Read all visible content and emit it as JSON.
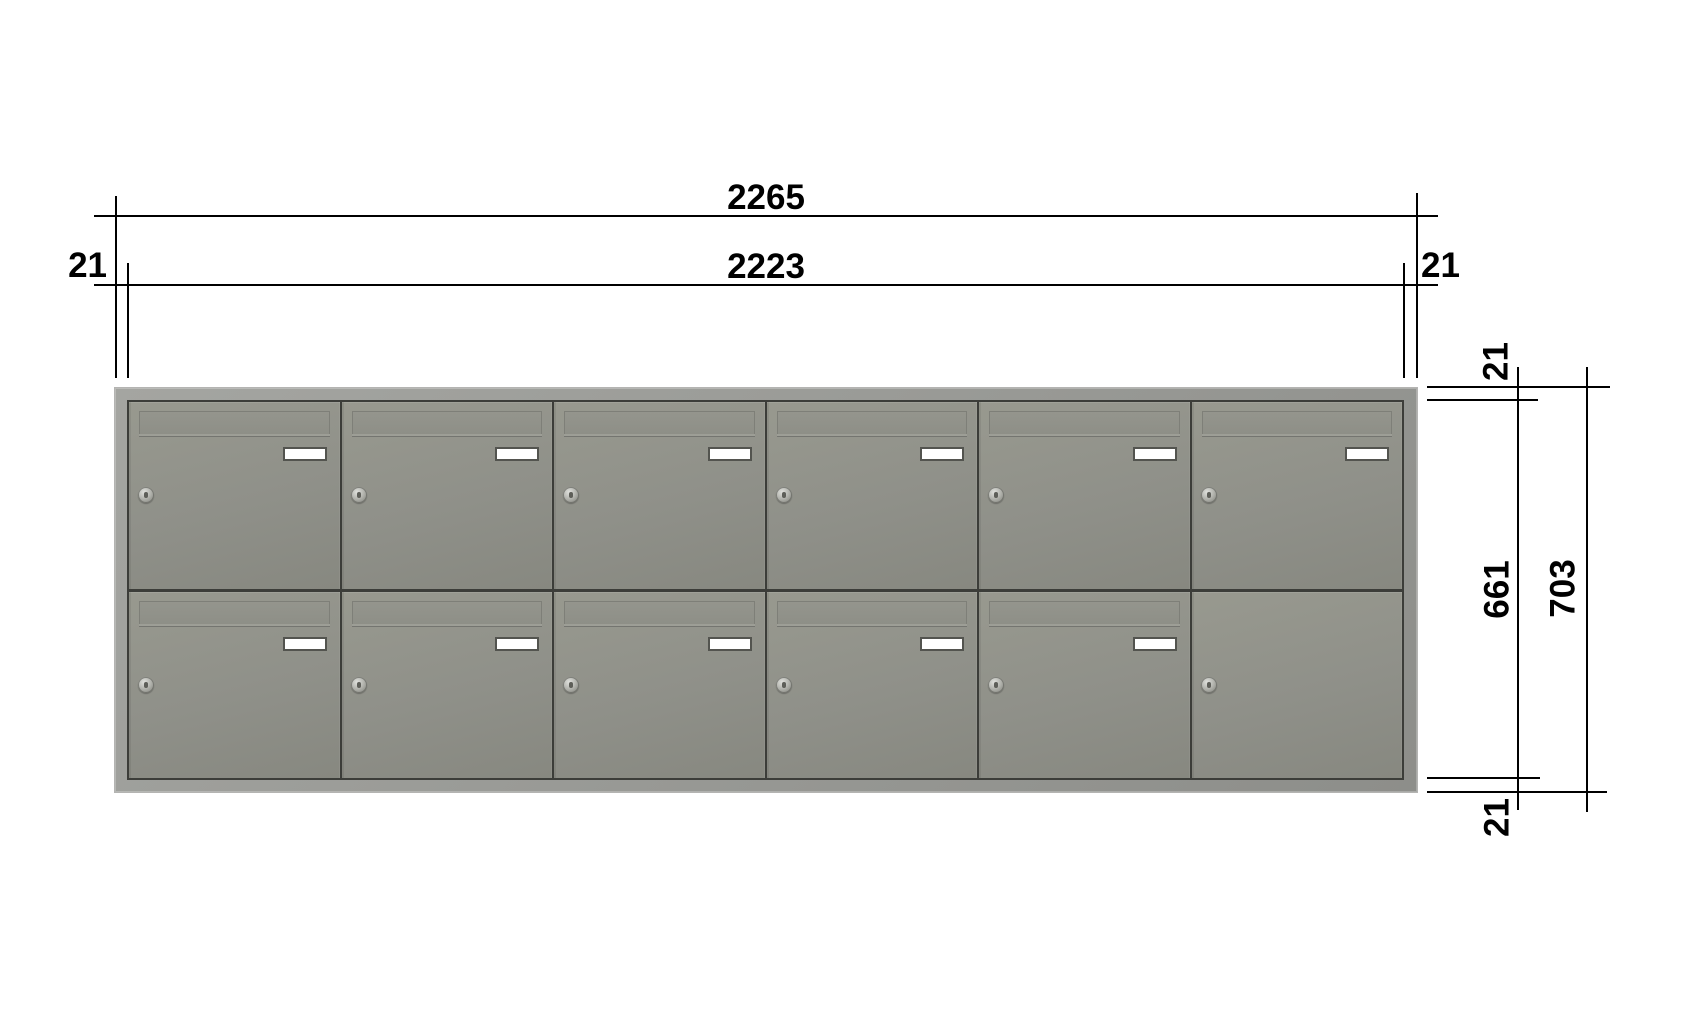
{
  "drawing": {
    "type": "letterbox-bank-dimension-drawing",
    "dimensions": {
      "overall_width": "2265",
      "inner_width": "2223",
      "left_frame": "21",
      "right_frame": "21",
      "top_frame": "21",
      "bottom_frame": "21",
      "inner_height": "661",
      "overall_height": "703"
    },
    "cabinet": {
      "rows": 2,
      "columns": 6,
      "doors": [
        {
          "flap": true,
          "plate": true,
          "lock": true
        },
        {
          "flap": true,
          "plate": true,
          "lock": true
        },
        {
          "flap": true,
          "plate": true,
          "lock": true
        },
        {
          "flap": true,
          "plate": true,
          "lock": true
        },
        {
          "flap": true,
          "plate": true,
          "lock": true
        },
        {
          "flap": true,
          "plate": true,
          "lock": true
        },
        {
          "flap": true,
          "plate": true,
          "lock": true
        },
        {
          "flap": true,
          "plate": true,
          "lock": true
        },
        {
          "flap": true,
          "plate": true,
          "lock": true
        },
        {
          "flap": true,
          "plate": true,
          "lock": true
        },
        {
          "flap": true,
          "plate": true,
          "lock": true
        },
        {
          "flap": false,
          "plate": false,
          "lock": true
        }
      ]
    },
    "colors": {
      "background": "#ffffff",
      "line": "#000000",
      "frame": "#9a9b97",
      "door": "#8f9089",
      "divider": "#3c3d39",
      "plate_fill": "#ffffff",
      "plate_border": "#53544f"
    }
  }
}
